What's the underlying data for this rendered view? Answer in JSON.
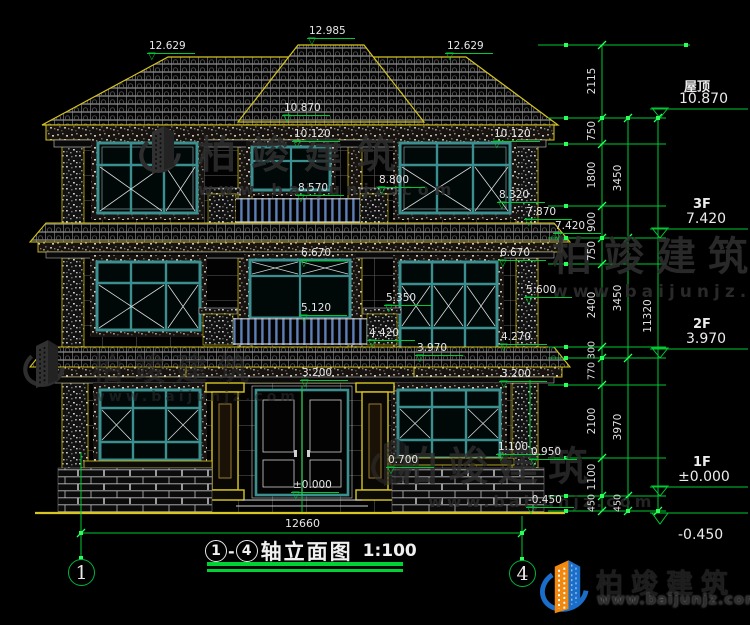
{
  "watermark": {
    "brand": "柏竣建筑",
    "url": "www.baijunjz.com"
  },
  "logo": {
    "brand": "柏竣建筑",
    "url": "www.baijunjz.com"
  },
  "title": {
    "axis_start": "1",
    "separator": "-",
    "axis_end": "4",
    "text": "轴立面图",
    "scale": "1:100"
  },
  "axes": {
    "left": "1",
    "right": "4"
  },
  "bottom_dimension": "12660",
  "levels": [
    {
      "label": "屋顶",
      "value": "10.870"
    },
    {
      "label": "3F",
      "value": "7.420"
    },
    {
      "label": "2F",
      "value": "3.970"
    },
    {
      "label": "1F",
      "value": "±0.000"
    },
    {
      "label": "",
      "value": "-0.450"
    }
  ],
  "marks": [
    {
      "v": "12.629"
    },
    {
      "v": "12.985"
    },
    {
      "v": "12.629"
    },
    {
      "v": "10.870"
    },
    {
      "v": "10.120"
    },
    {
      "v": "10.120"
    },
    {
      "v": "8.570"
    },
    {
      "v": "8.800"
    },
    {
      "v": "8.320"
    },
    {
      "v": "7.870"
    },
    {
      "v": "7.420"
    },
    {
      "v": "6.670"
    },
    {
      "v": "6.670"
    },
    {
      "v": "5.600"
    },
    {
      "v": "5.350"
    },
    {
      "v": "5.120"
    },
    {
      "v": "4.420"
    },
    {
      "v": "4.270"
    },
    {
      "v": "3.970"
    },
    {
      "v": "3.200"
    },
    {
      "v": "3.200"
    },
    {
      "v": "1.100"
    },
    {
      "v": "0.950"
    },
    {
      "v": "0.700"
    },
    {
      "v": "±0.000"
    },
    {
      "v": "-0.450"
    }
  ],
  "chains": {
    "inner": [
      "2115",
      "750",
      "1800",
      "900",
      "750",
      "2400",
      "300",
      "770",
      "2100",
      "1100",
      "450"
    ],
    "middle": [
      "3450",
      "3450",
      "3970",
      "450"
    ],
    "outer": [
      "11320"
    ]
  }
}
